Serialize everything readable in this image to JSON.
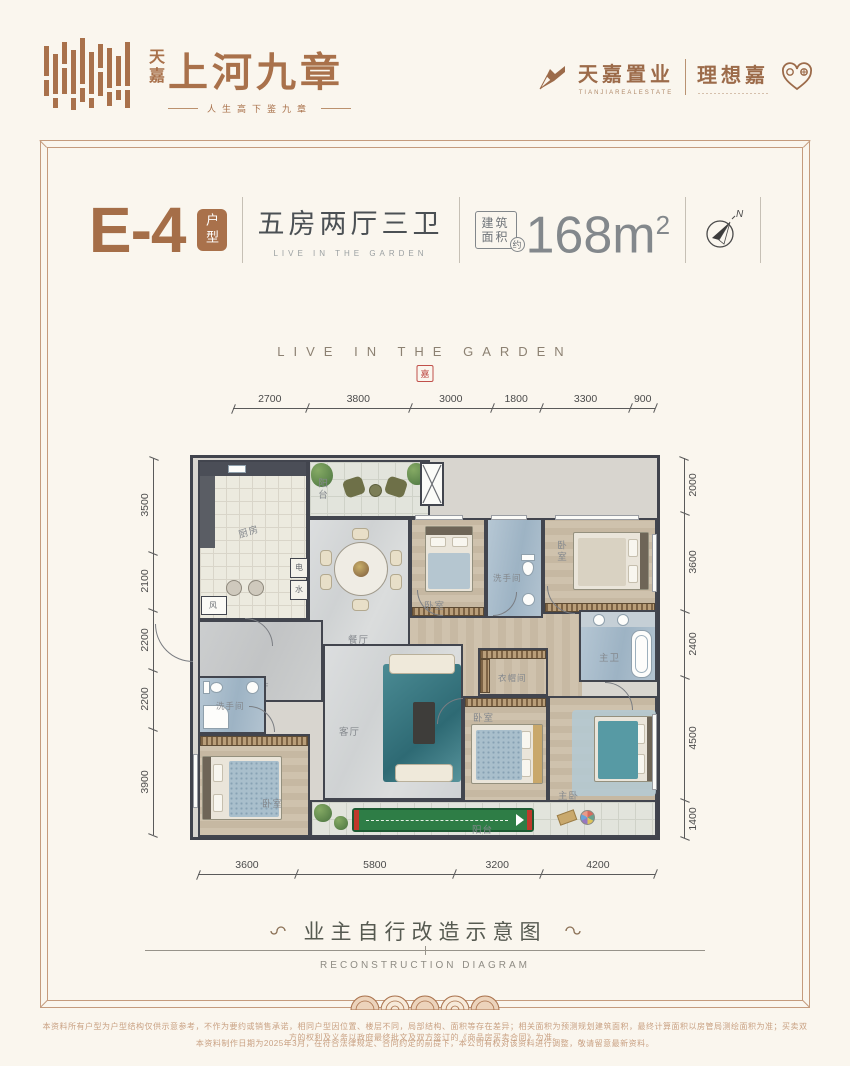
{
  "colors": {
    "brand": "#a9714b",
    "title_dark": "#4b5054",
    "area_gray": "#83888c",
    "wall": "#40434c",
    "bath_blue": "#a8bccb",
    "teal_bed": "#579aa4",
    "golf_green": "#2e7d46",
    "seal_red": "#c0504a",
    "fineprint": "#c9a183"
  },
  "header": {
    "logo": {
      "brand_cn_small": "天嘉",
      "brand_cn_main": "上河九章",
      "tagline": "人生高下鉴九章"
    },
    "corp": {
      "name": "天嘉置业",
      "name_en": "TIANJIAREALESTATE",
      "partner": "理想嘉"
    }
  },
  "title": {
    "unit": "E-4",
    "unit_tag": "户型",
    "layout": "五房两厅三卫",
    "layout_en": "LIVE IN THE GARDEN",
    "area_line1": "建筑",
    "area_line2": "面积",
    "area_approx": "约",
    "area_value": "168",
    "area_unit": "m",
    "area_sup": "2",
    "compass_n": "N"
  },
  "watermark": {
    "text": "LIVE IN THE GARDEN",
    "seal": "嘉"
  },
  "plan": {
    "dims": {
      "top": [
        "2700",
        "3800",
        "3000",
        "1800",
        "3300",
        "900"
      ],
      "bottom": [
        "3600",
        "5800",
        "3200",
        "4200"
      ],
      "left": [
        "3500",
        "2100",
        "2200",
        "2200",
        "3900"
      ],
      "right": [
        "2000",
        "3600",
        "2400",
        "4500",
        "1400"
      ]
    },
    "rooms": {
      "kitchen": "厨房",
      "balcony_top": "阳台",
      "dining": "餐厅",
      "bedroom_top": "卧室",
      "washroom_top": "洗手间",
      "bedroom_top_right": "卧室",
      "master_bath": "主卫",
      "elevator_hall": "电梯厅",
      "utility_power": "电",
      "utility_water": "水",
      "vent": "风",
      "washroom_left": "洗手间",
      "bedroom_left": "卧室",
      "living": "客厅",
      "cloakroom": "衣帽间",
      "bedroom_mid": "卧室",
      "master_bedroom": "主卧",
      "balcony_bottom": "阳台"
    }
  },
  "caption": {
    "title": "业主自行改造示意图",
    "subtitle": "RECONSTRUCTION DIAGRAM"
  },
  "disclaimer": {
    "line1": "本资料所有户型为户型结构仅供示意参考，不作为要约或销售承诺，相同户型因位置、楼层不同，局部结构、面积等存在差异；相关面积为预测规划建筑面积，最终计算面积以房管局测绘面积为准；买卖双方的权利及义务以政府最终批文及双方签订的《商品房买卖合同》为准。",
    "line2": "本资料制作日期为2025年3月，在符合法律规定、合同约定的前提下，本公司有权对该资料进行调整，敬请留意最新资料。"
  }
}
